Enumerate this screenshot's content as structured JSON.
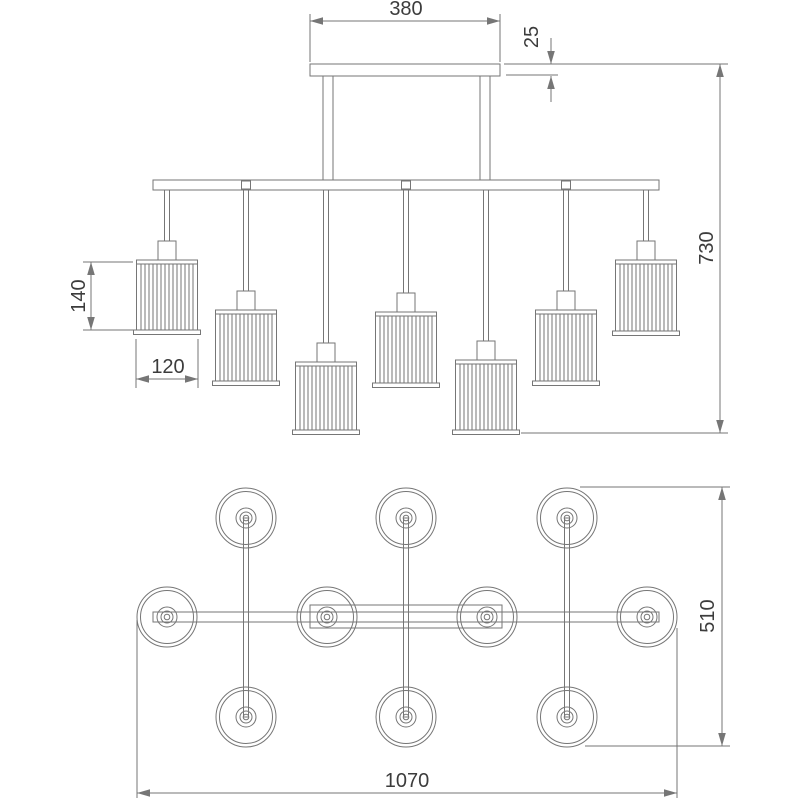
{
  "page": {
    "type": "technical-dimension-drawing",
    "subject": "linear-chandelier-7-arm",
    "background": "#ffffff"
  },
  "style": {
    "line_color": "#767676",
    "text_color": "#3c3c3c",
    "fill_color": "#ffffff",
    "font_size": 20,
    "arrow_len": 13,
    "arrow_half": 3.8
  },
  "drawing": {
    "views": {
      "front": {
        "name": "front-elevation",
        "canopy": {
          "x": 310,
          "y": 64,
          "w": 190,
          "h": 12
        },
        "stems": [
          {
            "x": 323,
            "y": 76,
            "w": 10,
            "h": 104
          },
          {
            "x": 480,
            "y": 76,
            "w": 10,
            "h": 104
          }
        ],
        "bar": {
          "x": 153,
          "y": 180,
          "w": 506,
          "h": 10
        },
        "connectors": [
          {
            "cx": 246
          },
          {
            "cx": 406
          },
          {
            "cx": 566
          }
        ],
        "lamp_style": {
          "rod_w": 5,
          "cup_w": 18,
          "shade_w": 61,
          "band_h": 4,
          "base_overhang": 3,
          "rib_count": 13
        },
        "lamps": [
          {
            "cx": 167,
            "cup_top": 241,
            "shade_top": 260,
            "shade_bottom": 334
          },
          {
            "cx": 246,
            "cup_top": 291,
            "shade_top": 310,
            "shade_bottom": 385
          },
          {
            "cx": 326,
            "cup_top": 343,
            "shade_top": 362,
            "shade_bottom": 434
          },
          {
            "cx": 406,
            "cup_top": 293,
            "shade_top": 312,
            "shade_bottom": 387
          },
          {
            "cx": 486,
            "cup_top": 341,
            "shade_top": 360,
            "shade_bottom": 434
          },
          {
            "cx": 566,
            "cup_top": 291,
            "shade_top": 310,
            "shade_bottom": 385
          },
          {
            "cx": 646,
            "cup_top": 241,
            "shade_top": 260,
            "shade_bottom": 335
          }
        ]
      },
      "plan": {
        "name": "plan-view",
        "bar": {
          "x": 153,
          "y": 612,
          "w": 506,
          "h": 10
        },
        "canopy": {
          "x": 310,
          "y": 605,
          "w": 192,
          "h": 23
        },
        "shade_style": {
          "r_outer": 30,
          "r_rim": 26.5,
          "r_hub": 10,
          "r_hub_inner": 6,
          "r_pin": 2.8,
          "arm_w": 5
        },
        "arms": [
          {
            "cx": 246,
            "y1": 518,
            "y2": 717
          },
          {
            "cx": 406,
            "y1": 518,
            "y2": 717
          },
          {
            "cx": 567,
            "y1": 518,
            "y2": 717
          }
        ],
        "shades": [
          {
            "cx": 246,
            "cy": 518
          },
          {
            "cx": 406,
            "cy": 518
          },
          {
            "cx": 567,
            "cy": 518
          },
          {
            "cx": 167,
            "cy": 617
          },
          {
            "cx": 327,
            "cy": 617
          },
          {
            "cx": 487,
            "cy": 617
          },
          {
            "cx": 647,
            "cy": 617
          },
          {
            "cx": 246,
            "cy": 717
          },
          {
            "cx": 406,
            "cy": 717
          },
          {
            "cx": 567,
            "cy": 717
          }
        ]
      }
    },
    "dimensions": [
      {
        "id": "canopy-width",
        "label": "380",
        "orient": "h",
        "arrows": "inside",
        "line": {
          "y": 21,
          "x1": 310,
          "x2": 500
        },
        "ext": [
          {
            "x1": 310,
            "y1": 14,
            "x2": 310,
            "y2": 62
          },
          {
            "x1": 500,
            "y1": 14,
            "x2": 500,
            "y2": 62
          }
        ],
        "text": {
          "x": 406,
          "y": 15,
          "rotate": false
        }
      },
      {
        "id": "canopy-thickness",
        "label": "25",
        "orient": "v",
        "arrows": "outside",
        "tail": 26,
        "line": {
          "x": 551,
          "y1": 64,
          "y2": 76
        },
        "ext": [
          {
            "x1": 506,
            "y1": 75,
            "x2": 558,
            "y2": 75
          }
        ],
        "text": {
          "x": 538,
          "y": 37,
          "rotate": true
        }
      },
      {
        "id": "overall-height",
        "label": "730",
        "orient": "v",
        "arrows": "inside",
        "line": {
          "x": 720,
          "y1": 64,
          "y2": 433
        },
        "ext": [
          {
            "x1": 504,
            "y1": 64,
            "x2": 728,
            "y2": 64
          },
          {
            "x1": 521,
            "y1": 433,
            "x2": 728,
            "y2": 433
          }
        ],
        "text": {
          "x": 713,
          "y": 248,
          "rotate": true
        }
      },
      {
        "id": "shade-height",
        "label": "140",
        "orient": "v",
        "arrows": "inside",
        "line": {
          "x": 91,
          "y1": 262,
          "y2": 330
        },
        "ext": [
          {
            "x1": 83,
            "y1": 262,
            "x2": 133,
            "y2": 262
          },
          {
            "x1": 83,
            "y1": 330,
            "x2": 133,
            "y2": 330
          }
        ],
        "text": {
          "x": 85,
          "y": 296,
          "rotate": true
        }
      },
      {
        "id": "shade-width",
        "label": "120",
        "orient": "h",
        "arrows": "inside",
        "line": {
          "y": 379,
          "x1": 136,
          "x2": 198
        },
        "ext": [
          {
            "x1": 136,
            "y1": 339,
            "x2": 136,
            "y2": 388
          },
          {
            "x1": 198,
            "y1": 339,
            "x2": 198,
            "y2": 388
          }
        ],
        "text": {
          "x": 168,
          "y": 373,
          "rotate": false
        }
      },
      {
        "id": "overall-width",
        "label": "1070",
        "orient": "h",
        "arrows": "inside",
        "line": {
          "y": 793,
          "x1": 137,
          "x2": 677
        },
        "ext": [
          {
            "x1": 137,
            "y1": 620,
            "x2": 137,
            "y2": 798
          },
          {
            "x1": 677,
            "y1": 628,
            "x2": 677,
            "y2": 798
          }
        ],
        "text": {
          "x": 407,
          "y": 787,
          "rotate": false
        }
      },
      {
        "id": "overall-depth",
        "label": "510",
        "orient": "v",
        "arrows": "inside",
        "line": {
          "x": 722,
          "y1": 487,
          "y2": 746
        },
        "ext": [
          {
            "x1": 580,
            "y1": 487,
            "x2": 730,
            "y2": 487
          },
          {
            "x1": 585,
            "y1": 746,
            "x2": 730,
            "y2": 746
          }
        ],
        "text": {
          "x": 714,
          "y": 616,
          "rotate": true
        }
      }
    ]
  }
}
